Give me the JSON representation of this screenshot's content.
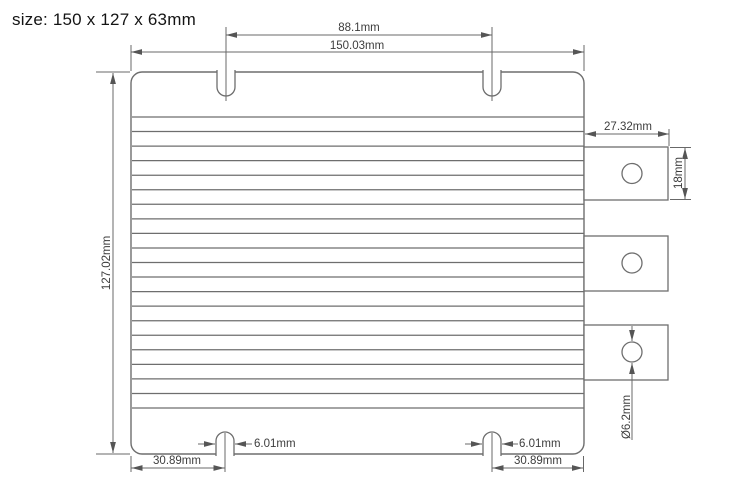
{
  "title": "size: 150 x 127 x 63mm",
  "drawing": {
    "labels": {
      "slots_span": "88.1mm",
      "overall_width": "150.03mm",
      "overall_height": "127.02mm",
      "tab_width": "27.32mm",
      "tab_height": "18mm",
      "hole_diameter": "Ø6.2mm",
      "slot_width_left": "6.01mm",
      "slot_width_right": "6.01mm",
      "slot_offset_left": "30.89mm",
      "slot_offset_right": "30.89mm"
    },
    "line_color": "#6e6e6e",
    "dim_color": "#686868",
    "text_color": "#3d3d3d",
    "fin_count": 21
  }
}
